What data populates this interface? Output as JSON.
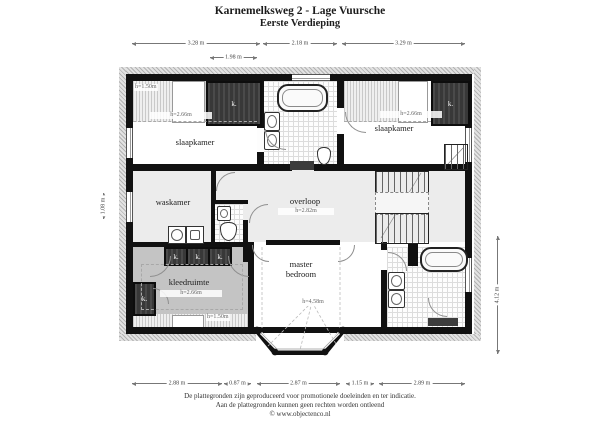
{
  "title": {
    "line1": "Karnemelksweg 2 - Lage Vuursche",
    "line2": "Eerste Verdieping"
  },
  "rooms": {
    "slaapkamer_left": {
      "name": "slaapkamer",
      "ceiling": "h=2.66m",
      "low": "h=1.50m"
    },
    "slaapkamer_right": {
      "name": "slaapkamer",
      "ceiling": "h=2.66m"
    },
    "waskamer": {
      "name": "waskamer"
    },
    "overloop": {
      "name": "overloop",
      "ceiling": "h=2.82m"
    },
    "kleedruimte": {
      "name": "kleedruimte",
      "ceiling": "h=2.66m",
      "low": "h=1.50m"
    },
    "master_bedroom": {
      "name": "master bedroom",
      "ceiling": "h=4.58m"
    }
  },
  "labels": {
    "closet": "k."
  },
  "dimensions": {
    "top": [
      "3.28 m",
      "2.18 m",
      "3.29 m"
    ],
    "top_sub": "1.98 m",
    "bottom": [
      "2.88 m",
      "0.87 m",
      "2.87 m",
      "1.15 m",
      "2.89 m"
    ],
    "left": "1.08 m",
    "right": "4.12 m"
  },
  "footer": {
    "line1": "De plattegronden zijn geproduceerd voor promotionele doeleinden en ter indicatie.",
    "line2": "Aan de plattegronden kunnen geen rechten worden ontleend",
    "line3": "© www.objectenco.nl"
  },
  "colors": {
    "wall": "#111111",
    "closet_fill": "#3f3f3f",
    "floor_light": "#ececec",
    "floor_gray": "#c4c4c4",
    "tile_line": "#dcdcdc"
  }
}
